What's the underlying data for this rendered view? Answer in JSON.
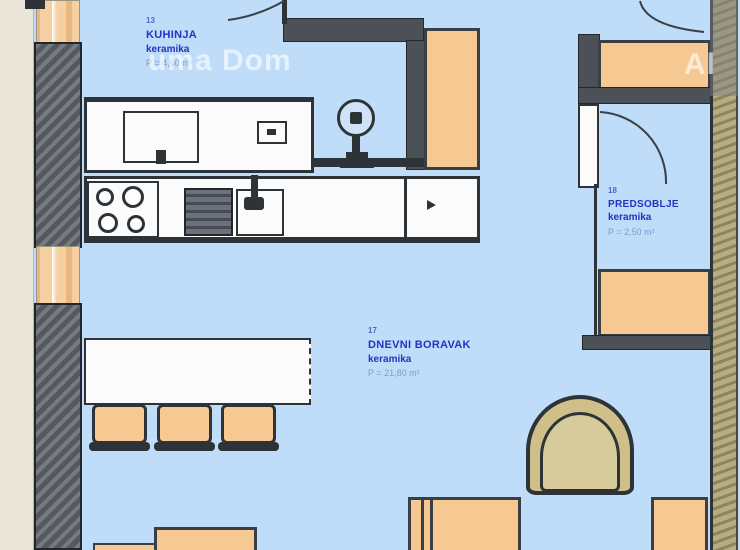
{
  "watermark": {
    "main": "uma Dom",
    "corner": "Al"
  },
  "rooms": {
    "kitchen": {
      "number": "13",
      "name": "KUHINJA",
      "material": "keramika",
      "area": "P = 4,60 m²"
    },
    "living": {
      "number": "17",
      "name": "DNEVNI BORAVAK",
      "material": "keramika",
      "area": "P = 21,80 m²"
    },
    "hall": {
      "number": "18",
      "name": "PREDSOBLJE",
      "material": "keramika",
      "area": "P = 2,50 m²"
    }
  },
  "colors": {
    "floor": "#bfdcf8",
    "outside": "#eae6da",
    "wall_dark": "#55595f",
    "window_tan": "#f6d0a2",
    "furniture_tan": "#f6c992",
    "armchair_khaki": "#cfc08a",
    "right_wall": "#b7ac82",
    "label_blue": "#2433c2",
    "watermark_white": "rgba(255,255,255,0.62)"
  }
}
